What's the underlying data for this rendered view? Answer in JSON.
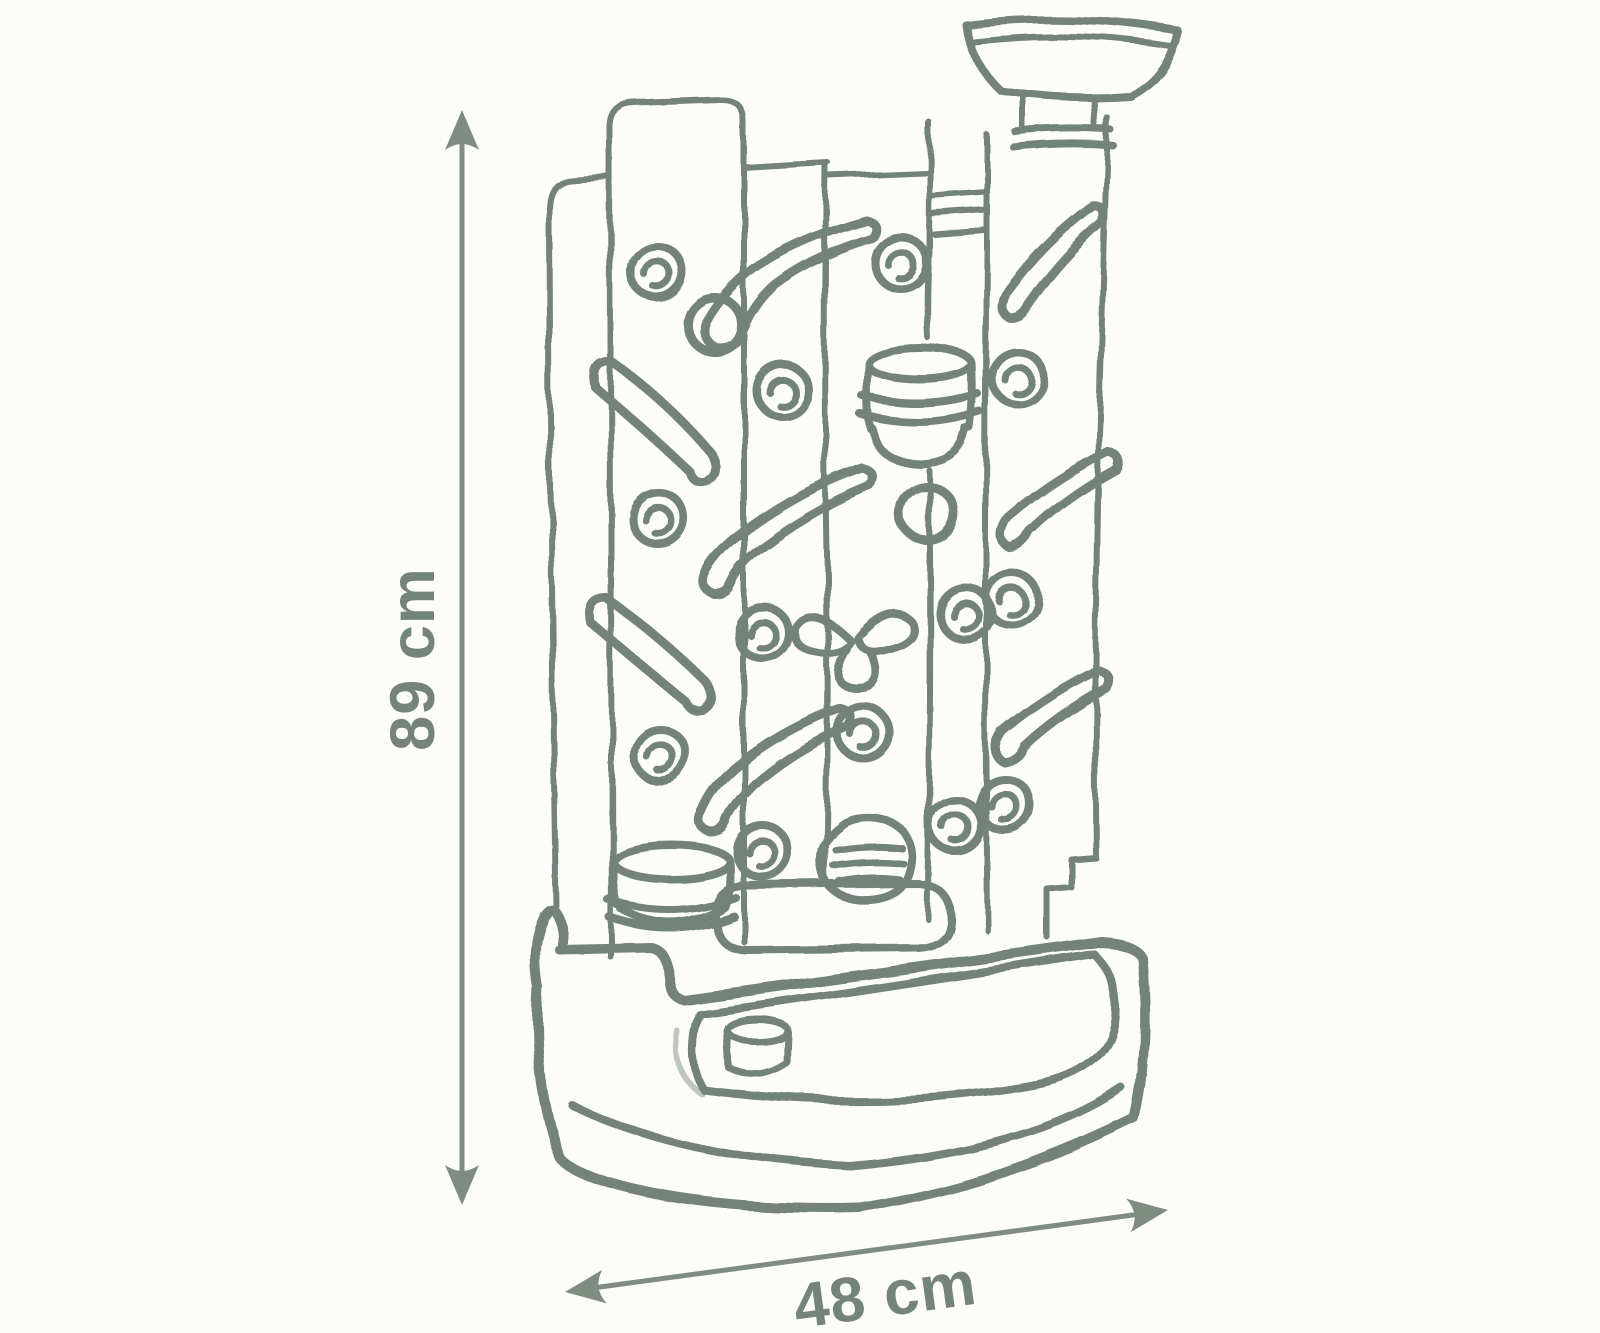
{
  "theme": {
    "background": "#fcfcfb",
    "sketch_color": "#73837a",
    "dimension_color": "#7e8c82",
    "label_color": "#75847a"
  },
  "diagram": {
    "type": "product-dimension-sketch",
    "dimensions": {
      "height": {
        "label": "89 cm"
      },
      "width": {
        "label": "48 cm"
      }
    }
  }
}
